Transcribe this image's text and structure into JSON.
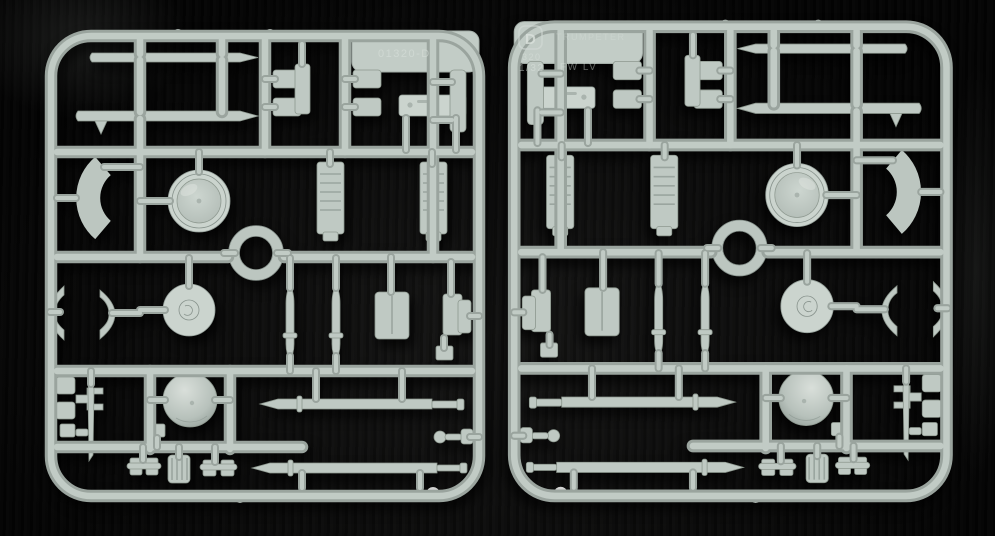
{
  "scene": {
    "type": "photograph",
    "description": "Two identical light-grey injection moulded styrene model kit sprues (runner frames) lying side by side on black fabric, the right one mirrored",
    "background_color": "#0a0a0a",
    "plastic_base": "#b8c2bc",
    "plastic_highlight": "#c1cbc5",
    "plastic_shadow": "#97a29c"
  },
  "left_sprue": {
    "label": "left sprue",
    "mold_text": "01320-D"
  },
  "right_sprue": {
    "label": "right sprue",
    "badge_letter": "D",
    "brand_text": "TRUMPETER",
    "mold_number": "320",
    "scale_text": "1/32",
    "subject_text": "FW  LV"
  }
}
